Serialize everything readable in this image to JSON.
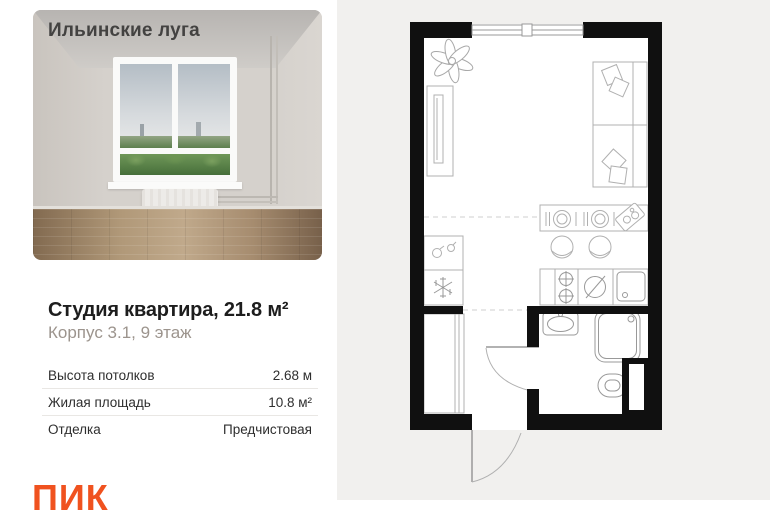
{
  "project": {
    "name": "Ильинские луга"
  },
  "listing": {
    "title": "Студия квартира, 21.8 м²",
    "subtitle": "Корпус 3.1, 9 этаж",
    "specs": [
      {
        "label": "Высота потолков",
        "value": "2.68 м"
      },
      {
        "label": "Жилая площадь",
        "value": "10.8 м²"
      },
      {
        "label": "Отделка",
        "value": "Предчистовая"
      }
    ]
  },
  "brand": {
    "logo_text": "ПИК",
    "logo_color": "#F0521F"
  },
  "floorplan": {
    "type": "studio-plan",
    "features": [
      "window",
      "plant",
      "wardrobe",
      "sofa-bed",
      "pillows",
      "bar-table",
      "place-settings",
      "tray",
      "chairs",
      "kitchen-counter",
      "fridge",
      "stove",
      "kitchen-sink",
      "dishwasher",
      "hall-closet",
      "bathroom-sink",
      "shower",
      "toilet",
      "duct-shaft",
      "bathroom-door",
      "entry-door"
    ],
    "colors": {
      "wall": "#101010",
      "furniture_line": "#b0b0b0",
      "fixture_line": "#999999",
      "panel_bg": "#f1f0ee"
    }
  }
}
